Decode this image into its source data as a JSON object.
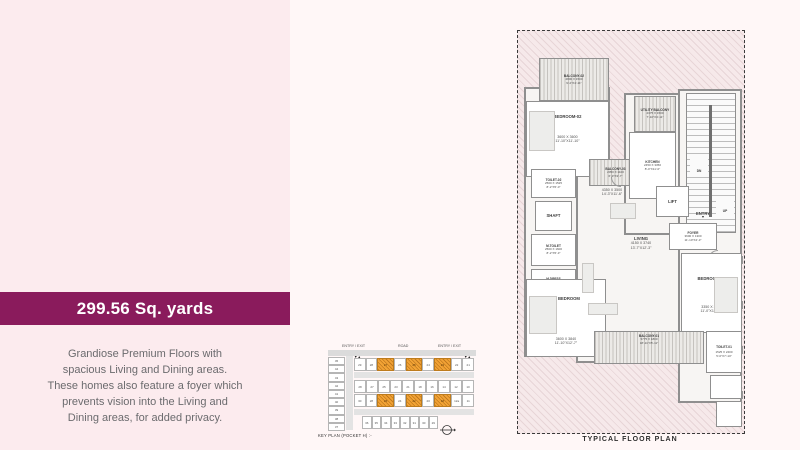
{
  "theme": {
    "left_panel_bg": "#fcebee",
    "right_panel_bg": "#fff7f7",
    "banner_bg": "#8a1b5c",
    "banner_text": "#ffffff",
    "highlight_orange": "#f2a335",
    "wall_gray": "#8f8f8f"
  },
  "banner": {
    "area_label": "299.56 Sq. yards"
  },
  "description": {
    "lines": [
      "Grandiose Premium Floors with",
      "spacious Living and Dining areas.",
      "These homes also feature a foyer which",
      "prevents vision into the Living and",
      "Dining areas, for added privacy."
    ]
  },
  "key_plan": {
    "title": "KEY PLAN (POCKET H) :-",
    "road_label": "ROAD",
    "entry_exit_left": "ENTRY / EXIT",
    "entry_exit_right": "ENTRY / EXIT",
    "left_column_plots": [
      "45",
      "44",
      "43",
      "42",
      "41",
      "40",
      "39",
      "38",
      "37"
    ],
    "rows": [
      {
        "plots": [
          {
            "n": "29"
          },
          {
            "n": "28"
          },
          {
            "n": "27",
            "h": true
          },
          {
            "n": "26"
          },
          {
            "n": "25",
            "h": true
          },
          {
            "n": "24"
          },
          {
            "n": "23",
            "h": true
          },
          {
            "n": "22"
          },
          {
            "n": "21"
          }
        ]
      },
      {
        "plots": [
          {
            "n": "28"
          },
          {
            "n": "27"
          },
          {
            "n": "25"
          },
          {
            "n": "23"
          },
          {
            "n": "21"
          },
          {
            "n": "18"
          },
          {
            "n": "16"
          },
          {
            "n": "14"
          },
          {
            "n": "12"
          },
          {
            "n": "10"
          }
        ]
      },
      {
        "plots": [
          {
            "n": "30"
          },
          {
            "n": "28"
          },
          {
            "n": "26",
            "h": true
          },
          {
            "n": "24"
          },
          {
            "n": "22",
            "h": true
          },
          {
            "n": "20"
          },
          {
            "n": "18",
            "h": true
          },
          {
            "n": "12a"
          },
          {
            "n": "11"
          }
        ]
      },
      {
        "plots": [
          {
            "n": "36"
          },
          {
            "n": "35"
          },
          {
            "n": "34"
          },
          {
            "n": "33"
          },
          {
            "n": "32"
          },
          {
            "n": "31"
          },
          {
            "n": "30"
          },
          {
            "n": "29"
          }
        ]
      }
    ]
  },
  "floor_plan": {
    "caption": "TYPICAL FLOOR PLAN",
    "rooms": {
      "balcony02": {
        "name": "BALCONY-02",
        "dim_mm": "2800 X 1500",
        "dim_ft": "9'-2\"X4'-11\""
      },
      "bedroom02": {
        "name": "BEDROOM-02",
        "dim_mm": "3600 X 3600",
        "dim_ft": "11'-10\"X11'-10\""
      },
      "utility_balcony": {
        "name": "UTILITY BALCONY",
        "dim_mm": "2375 X 1500",
        "dim_ft": "7'-10\"X4'-11\""
      },
      "kitchen": {
        "name": "KITCHEN",
        "dim_mm": "2450 X 3350",
        "dim_ft": "8'-0\"X11'-0\""
      },
      "toilet02": {
        "name": "TOILET-02",
        "dim_mm": "2500 X 1525",
        "dim_ft": "8'-2\"X5'-0\""
      },
      "balcony03": {
        "name": "BALCONY-03",
        "dim_mm": "2050 X 1100",
        "dim_ft": "6'-9\"X3'-7\""
      },
      "dining": {
        "dim_mm": "4350 X 3500",
        "dim_ft": "14'-3\"X11'-6\""
      },
      "shaft": {
        "name": "SHAFT"
      },
      "lift": {
        "name": "LIFT"
      },
      "m_toilet": {
        "name": "M.TOILET",
        "dim_mm": "2500 X 1600",
        "dim_ft": "8'-2\"X5'-3\""
      },
      "m_dress": {
        "name": "M.DRESS",
        "dim_mm": "2500 X 1500",
        "dim_ft": "8'-2\"X4'-11\""
      },
      "living": {
        "name": "LIVING",
        "dim_mm": "4150 X 3740",
        "dim_ft": "13'-7\"X12'-3\""
      },
      "entry": {
        "name": "ENTRY"
      },
      "foyer": {
        "name": "FOYER",
        "dim_mm": "3600 X 1300",
        "dim_ft": "11'-10\"X4'-3\""
      },
      "bedroom01": {
        "name": "BEDROOM-01",
        "dim_mm": "3350 X 3640",
        "dim_ft": "11'-0\"X11'-11\""
      },
      "m_bedroom": {
        "name": "M. BEDROOM",
        "dim_mm": "3600 X 3840",
        "dim_ft": "11'-10\"X12'-7\""
      },
      "balcony01": {
        "name": "BALCONY-01",
        "dim_mm": "5775 X 1800",
        "dim_ft": "18'-11\"X5'-11\""
      },
      "toilet01": {
        "name": "TOILET-01",
        "dim_mm": "1525 X 2400",
        "dim_ft": "5'-0\"X7'-10\""
      },
      "stairs_down": {
        "name": "DN"
      },
      "stairs_up": {
        "name": "UP"
      }
    }
  }
}
